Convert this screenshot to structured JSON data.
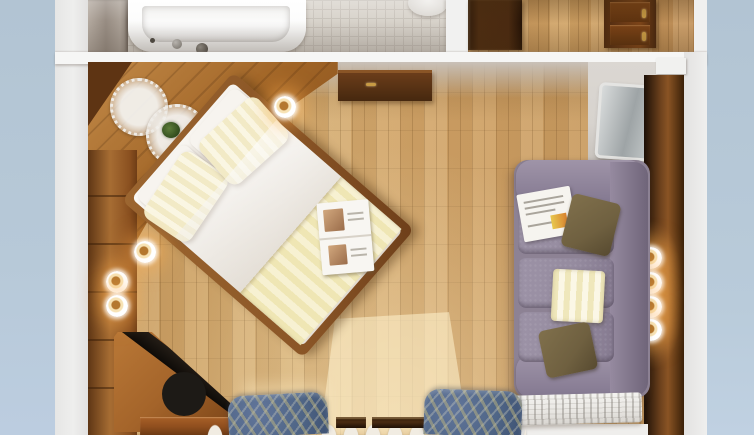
{
  "scene": {
    "type": "3d-floorplan-top-down-render",
    "description": "Top-down architectural render of a hotel guest room with en-suite bathroom, entry hall, double bed, sofa and window seating",
    "rooms": [
      {
        "name": "bathroom",
        "objects": [
          "bathtub",
          "tub-faucet",
          "toilet",
          "tiled-floor",
          "bathroom-door"
        ]
      },
      {
        "name": "hallway",
        "objects": [
          "entry-door",
          "wooden-dresser",
          "parquet-floor"
        ]
      },
      {
        "name": "bedroom",
        "objects": [
          "double-bed",
          "striped-pillows",
          "white-duvet",
          "striped-bed-runner",
          "open-magazine",
          "corner-bench",
          "lace-doily",
          "lace-doily-with-plant",
          "wood-panel-walls",
          "wall-lamps",
          "dark-sideboard",
          "tv-screen",
          "tv-niche",
          "sofa",
          "newspaper",
          "olive-cushions",
          "striped-blanket",
          "corner-tv-stand",
          "radiator",
          "armchair-left",
          "armchair-right",
          "sheer-curtains",
          "window-frames",
          "window-light-patch"
        ]
      }
    ]
  },
  "palette": {
    "blue": "#b2c4d3",
    "backdrop": "#e9e9e8",
    "tile": "#d8d3cb",
    "tileLine": "#c8c2ba",
    "tub": "#fbfbfa",
    "dresser": "#6b3a16",
    "gold": "#c79a44",
    "bench": "#a06426",
    "panel": "#a76d33",
    "panelDark": "#5e3413",
    "bedFrame": "#8a5526",
    "duvet": "#f0ebe4",
    "pillow": "#f2eac6",
    "runner": "#efe6b4",
    "magazine": "#f8f6f2",
    "sofa": "#8d8294",
    "sofaSeat": "#958b9f",
    "sofaDark": "#6f6579",
    "cushion": "#6f6040",
    "blanket": "#efe7bb",
    "radiator": "#e9e7e3",
    "chair": "#4f6586",
    "chairLeaf": "#c9bd7e",
    "curtain": "#f1ece2",
    "sill": "#8f4e1e",
    "tv": "#b8bec0",
    "niche": "#d7d3ce"
  },
  "lamps": [
    {
      "x": 285,
      "y": 107
    },
    {
      "x": 145,
      "y": 252
    },
    {
      "x": 117,
      "y": 282
    },
    {
      "x": 117,
      "y": 306
    },
    {
      "x": 651,
      "y": 258
    },
    {
      "x": 651,
      "y": 283
    },
    {
      "x": 651,
      "y": 307
    },
    {
      "x": 651,
      "y": 330
    }
  ]
}
